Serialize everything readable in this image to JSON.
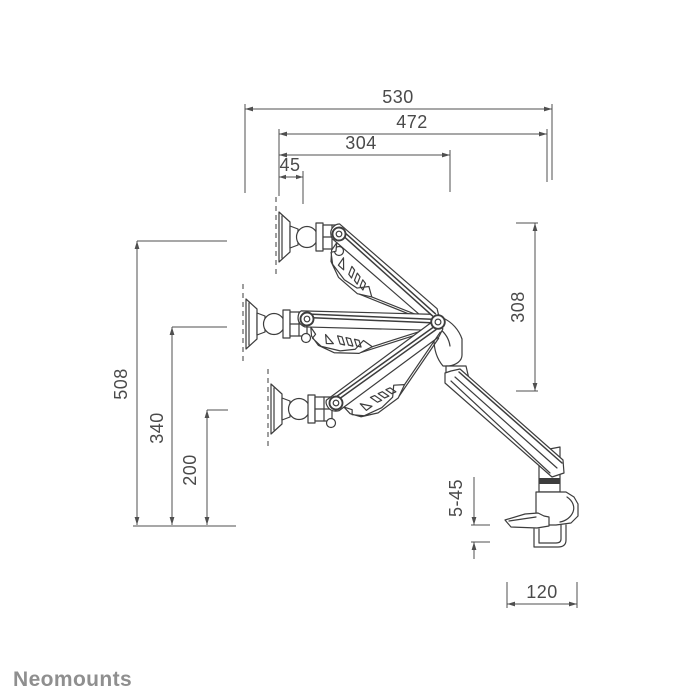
{
  "brand": {
    "name": "Neomounts"
  },
  "colors": {
    "background": "#ffffff",
    "line": "#3d3d3d",
    "dimension": "#4f4f4f",
    "text": "#4a4a4a",
    "brand": "#8f8f8f"
  },
  "dimensions": {
    "horizontal_top": [
      {
        "name": "full-horizontal-reach",
        "label": "530"
      },
      {
        "name": "arm-horizontal-reach",
        "label": "472"
      },
      {
        "name": "upper-arm-reach",
        "label": "304"
      },
      {
        "name": "head-pivot-offset",
        "label": "45"
      }
    ],
    "vertical_left": [
      {
        "name": "max-height",
        "label": "508"
      },
      {
        "name": "mid-height",
        "label": "340"
      },
      {
        "name": "min-height",
        "label": "200"
      }
    ],
    "vertical_right": [
      {
        "name": "vertical-adjustment-range",
        "label": "308"
      }
    ],
    "clamp": [
      {
        "name": "desk-thickness-range",
        "label": "5-45"
      },
      {
        "name": "clamp-base-depth",
        "label": "120"
      }
    ]
  }
}
